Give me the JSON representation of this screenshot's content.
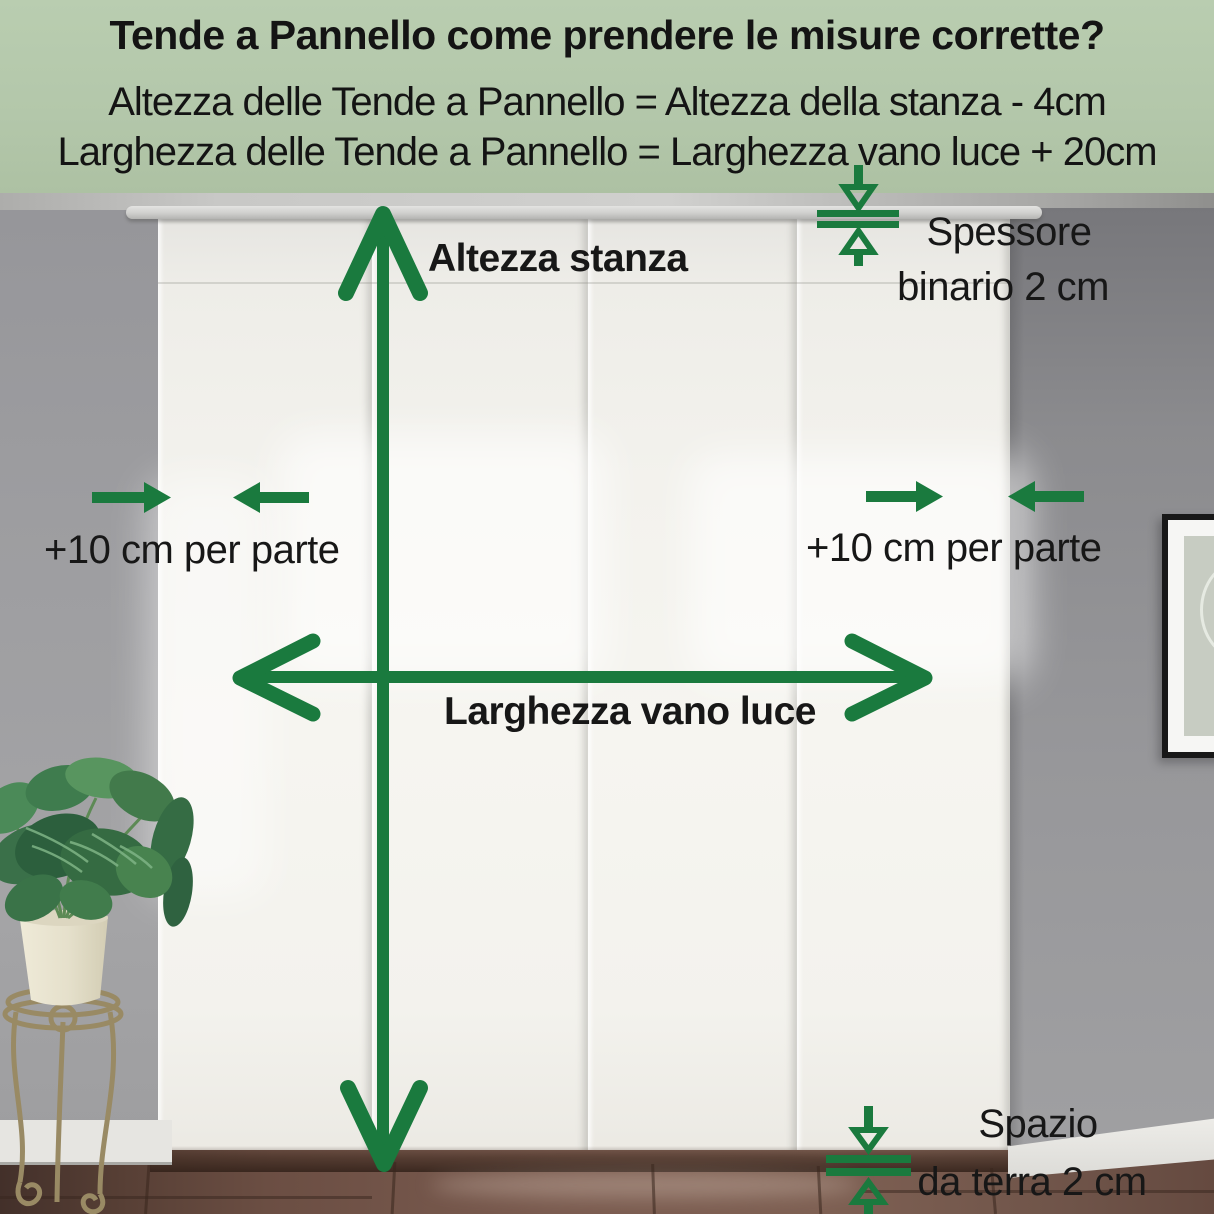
{
  "header": {
    "title": "Tende a Pannello come prendere le misure corrette?",
    "formula_height": "Altezza delle Tende a Pannello = Altezza della stanza - 4cm",
    "formula_width": "Larghezza delle Tende a Pannello = Larghezza vano luce + 20cm"
  },
  "annotations": {
    "room_height": "Altezza stanza",
    "opening_width": "Larghezza vano luce",
    "side_allowance": "+10 cm per parte",
    "rail_thickness_line1": "Spessore",
    "rail_thickness_line2": "binario 2 cm",
    "floor_gap_line1": "Spazio",
    "floor_gap_line2": "da terra 2 cm"
  },
  "colors": {
    "accent_green": "#1a7a3e",
    "header_background": "#b3c7aa",
    "text": "#141414"
  },
  "scene": {
    "curtain_panels_count": 4,
    "icons": [
      "room-height-double-arrow-icon",
      "opening-width-double-arrow-icon",
      "allowance-arrows-left-icon",
      "allowance-arrows-right-icon",
      "rail-thickness-gauge-icon",
      "floor-gap-gauge-icon"
    ]
  }
}
